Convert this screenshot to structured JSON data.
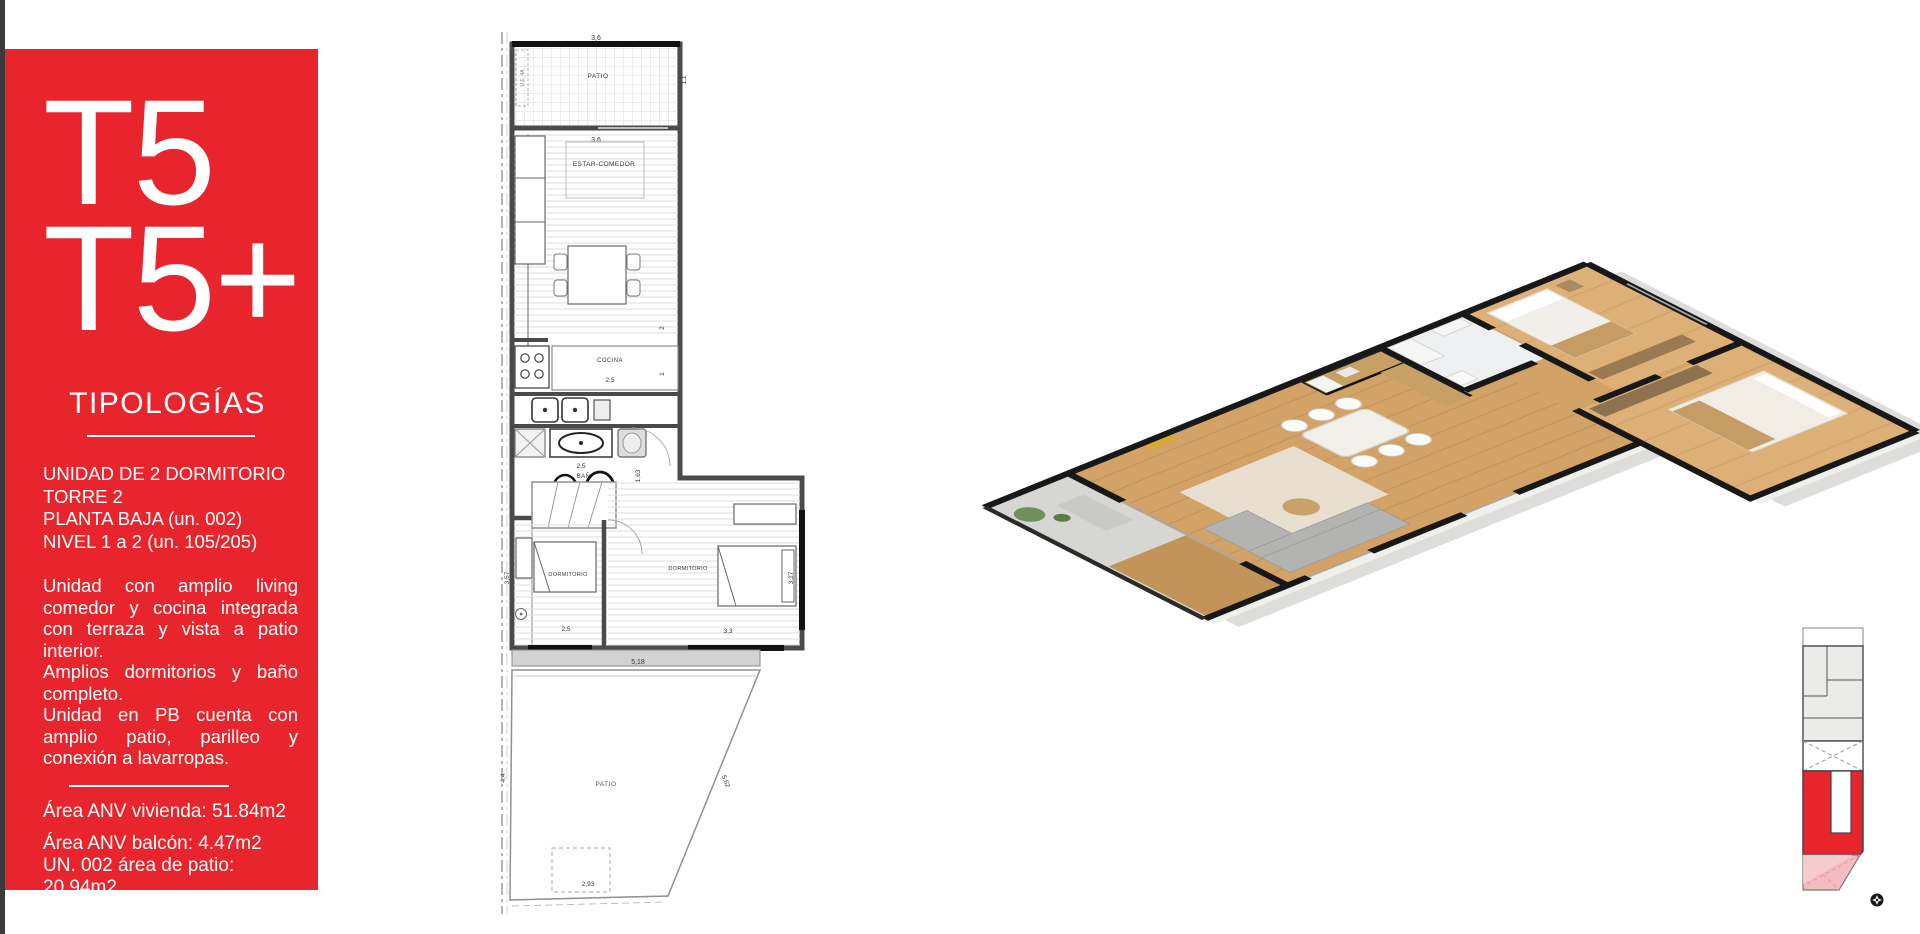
{
  "sidebar": {
    "accent_color": "#e8252c",
    "title_line1": "T5",
    "title_line2": "T5+",
    "section_title": "TIPOLOGÍAS",
    "unit_info": [
      "UNIDAD DE 2 DORMITORIO",
      "TORRE 2",
      "PLANTA BAJA (un. 002)",
      "NIVEL 1 a 2 (un. 105/205)"
    ],
    "description": [
      "Unidad con amplio living comedor y cocina integrada con terraza y vista a patio interior.",
      "Amplios dormitorios y baño completo.",
      "Unidad en PB cuenta con amplio patio, parilleo y conexión a lavarropas."
    ],
    "areas": {
      "vivienda": "Área ANV vivienda: 51.84m2",
      "balcon": "Área ANV balcón: 4.47m2",
      "patio": "UN. 002 área de patio: 20.94m2",
      "alfombra": "Área alfombra: 46.25m2"
    }
  },
  "floorplan": {
    "unit_code": "U.E. 4A",
    "rooms": {
      "patio_top": "PATIO",
      "living": "ESTAR-COMEDOR",
      "kitchen": "COCINA",
      "bathroom": "BAÑO",
      "bedroom1": "DORMITORIO",
      "bedroom2": "DORMITORIO",
      "patio_bottom": "PATIO"
    },
    "dimensions": {
      "patio_top_width": "3,6",
      "patio_top_depth": "1,1",
      "living_width": "3,6",
      "living_depth": "3,5",
      "kitchen_width": "2,5",
      "kitchen_depth": "2",
      "hall_width": "1",
      "bath_width": "2,5",
      "bath_depth": "1,63",
      "bedroom1_width": "2,5",
      "bedroom1_depth": "3,57",
      "bedroom2_width": "3,3",
      "bedroom2_depth": "3,27",
      "patio_width": "5,18",
      "patio_depth": "4,4",
      "patio_diagonal": "5,62",
      "patio_bottom_width": "2,93"
    }
  }
}
